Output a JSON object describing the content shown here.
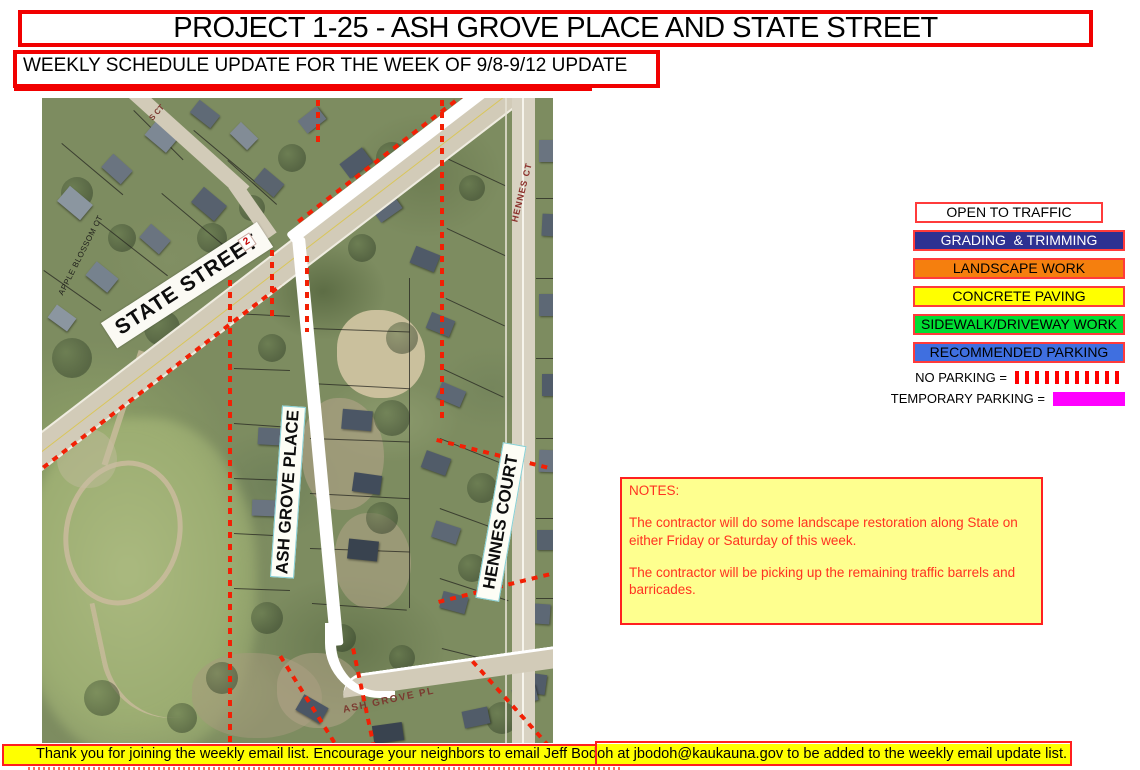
{
  "header": {
    "title": "PROJECT 1-25 - ASH GROVE PLACE AND STATE STREET",
    "subtitle": "WEEKLY SCHEDULE UPDATE FOR THE WEEK OF 9/8-9/12 UPDATE"
  },
  "map": {
    "labels": {
      "state_street": "STATE STREET",
      "ash_grove_place": "ASH GROVE PLACE",
      "hennes_court": "HENNES COURT",
      "hennes_ct_small": "HENNES CT",
      "ash_grove_pl_small": "ASH GROVE PL",
      "apple_blossom_ct": "APPLE BLOSSOM CT",
      "s_ct_small": "S CT",
      "route_marker": "2"
    }
  },
  "legend": {
    "items": [
      {
        "label": "OPEN TO TRAFFIC",
        "bg": "#ffffff",
        "fg": "#000000"
      },
      {
        "label": "GRADING  & TRIMMING",
        "bg": "#2e3192",
        "fg": "#ffffff"
      },
      {
        "label": "LANDSCAPE WORK",
        "bg": "#f57f0e",
        "fg": "#000000"
      },
      {
        "label": "CONCRETE PAVING",
        "bg": "#ffff00",
        "fg": "#000000"
      },
      {
        "label": "SIDEWALK/DRIVEWAY WORK",
        "bg": "#00dd33",
        "fg": "#000000"
      },
      {
        "label": "RECOMMENDED PARKING",
        "bg": "#3f6fe0",
        "fg": "#000000"
      }
    ],
    "no_parking_label": "NO PARKING =",
    "temporary_parking_label": "TEMPORARY PARKING =",
    "no_parking_color": "#ff0000",
    "temporary_parking_color": "#ff00ff"
  },
  "notes": {
    "heading": "NOTES:",
    "paragraphs": [
      "The contractor will do some landscape restoration along State on either Friday or Saturday of this week.",
      "The contractor will be picking up the remaining traffic barrels and barricades."
    ]
  },
  "footer": {
    "message": "Thank you for joining the weekly email list. Encourage your neighbors to email Jeff Bodoh at jbodoh@kaukauna.gov to be added to the weekly email update list."
  }
}
